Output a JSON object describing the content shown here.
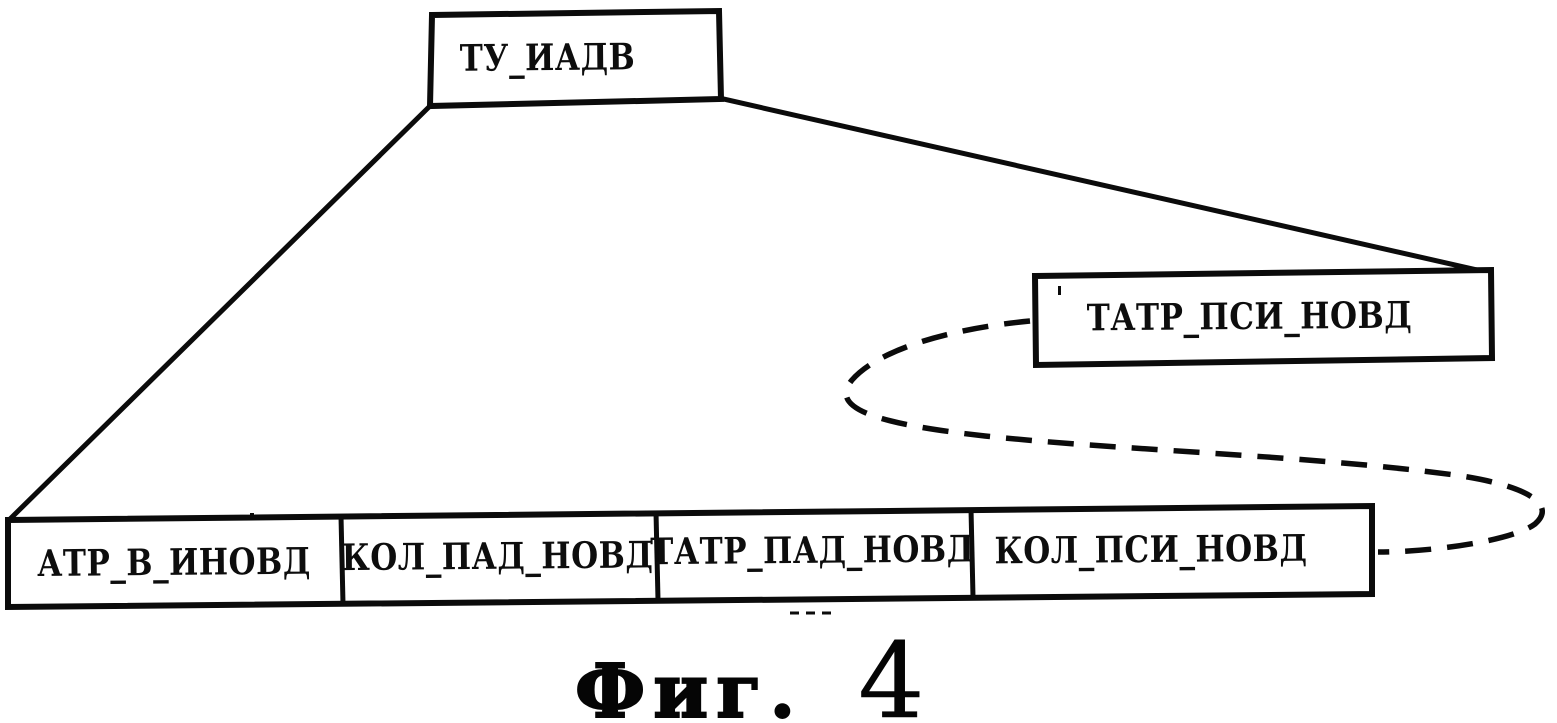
{
  "diagram": {
    "background": "#ffffff",
    "line_color": "#0b0b0b",
    "root_box": {
      "label": "ТУ_ИАДВ"
    },
    "side_box": {
      "label": "ТАТР_ПСИ_НОВД"
    },
    "bottom_cells": [
      {
        "label": "АТР_В_ИНОВД"
      },
      {
        "label": "КОЛ_ПАД_НОВД"
      },
      {
        "label": "ТАТР_ПАД_НОВД"
      },
      {
        "label": "КОЛ_ПСИ_НОВД"
      }
    ],
    "caption": {
      "text": "Фиг.",
      "number": "4"
    }
  }
}
